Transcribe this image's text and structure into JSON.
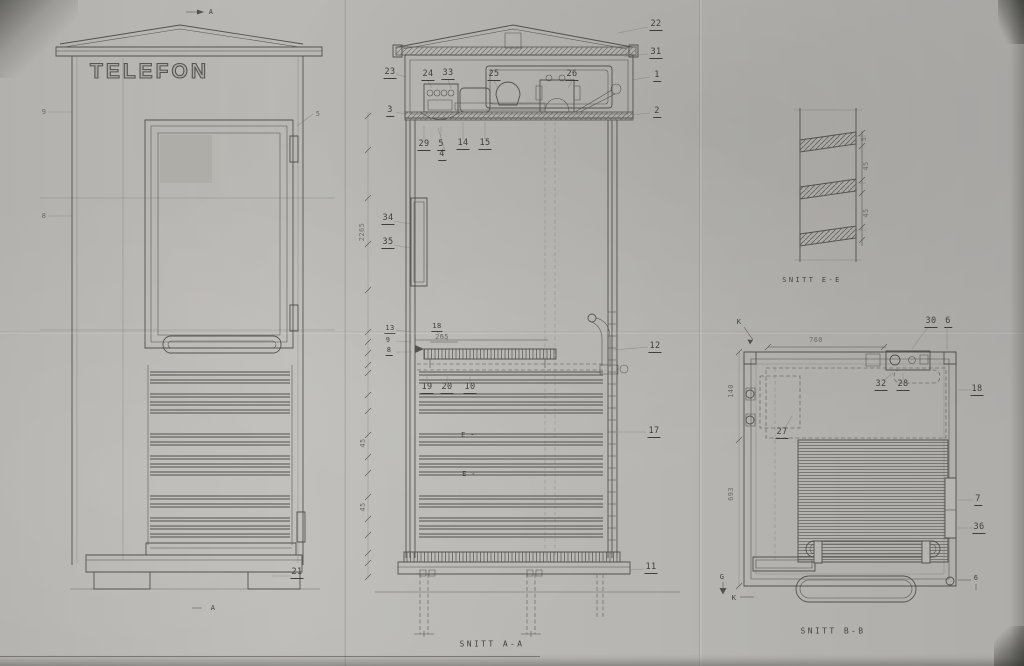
{
  "sheet": {
    "sign_text": "TELEFON"
  },
  "captions": {
    "section_aa": "SNITT A-A",
    "section_bb": "SNITT B-B",
    "section_ee": "SNITT E-E"
  },
  "colors": {
    "paper": "#b7b6b2",
    "line": "#46443f"
  },
  "part_labels": [
    {
      "t": "A",
      "x": 211,
      "y": 12,
      "sm": true,
      "name": "section-marker-a-top"
    },
    {
      "t": "9",
      "x": 44,
      "y": 112,
      "sm": true,
      "f": true
    },
    {
      "t": "8",
      "x": 44,
      "y": 216,
      "sm": true,
      "f": true
    },
    {
      "t": "5",
      "x": 318,
      "y": 114,
      "sm": true,
      "f": true
    },
    {
      "t": "21",
      "x": 297,
      "y": 573,
      "u": true
    },
    {
      "t": "A",
      "x": 213,
      "y": 608,
      "sm": true,
      "name": "section-marker-a-bottom"
    },
    {
      "t": "23",
      "x": 390,
      "y": 73,
      "u": true
    },
    {
      "t": "3",
      "x": 390,
      "y": 111,
      "u": true
    },
    {
      "t": "34",
      "x": 388,
      "y": 219,
      "u": true
    },
    {
      "t": "35",
      "x": 388,
      "y": 243,
      "u": true
    },
    {
      "t": "13",
      "x": 390,
      "y": 329,
      "u": true,
      "sm": true
    },
    {
      "t": "9",
      "x": 388,
      "y": 340,
      "sm": true
    },
    {
      "t": "8",
      "x": 389,
      "y": 351,
      "u": true,
      "sm": true
    },
    {
      "t": "24",
      "x": 428,
      "y": 75,
      "u": true
    },
    {
      "t": "33",
      "x": 448,
      "y": 74,
      "u": true
    },
    {
      "t": "25",
      "x": 494,
      "y": 75,
      "u": true
    },
    {
      "t": "26",
      "x": 572,
      "y": 75,
      "u": true
    },
    {
      "t": "29",
      "x": 424,
      "y": 145,
      "u": true
    },
    {
      "t": "5",
      "x": 441,
      "y": 145,
      "u": true
    },
    {
      "t": "14",
      "x": 463,
      "y": 144,
      "u": true
    },
    {
      "t": "15",
      "x": 485,
      "y": 144,
      "u": true
    },
    {
      "t": "4",
      "x": 442,
      "y": 155,
      "u": true
    },
    {
      "t": "18",
      "x": 437,
      "y": 327,
      "u": true,
      "sm": true
    },
    {
      "t": "265",
      "x": 442,
      "y": 337,
      "sm": true,
      "f": true,
      "name": "dimension-label"
    },
    {
      "t": "19",
      "x": 427,
      "y": 388,
      "u": true
    },
    {
      "t": "20",
      "x": 447,
      "y": 388,
      "u": true
    },
    {
      "t": "10",
      "x": 470,
      "y": 388,
      "u": true
    },
    {
      "t": "22",
      "x": 656,
      "y": 25,
      "u": true
    },
    {
      "t": "31",
      "x": 656,
      "y": 53,
      "u": true
    },
    {
      "t": "1",
      "x": 657,
      "y": 76,
      "u": true
    },
    {
      "t": "2",
      "x": 657,
      "y": 112,
      "u": true
    },
    {
      "t": "12",
      "x": 655,
      "y": 347,
      "u": true
    },
    {
      "t": "17",
      "x": 654,
      "y": 432,
      "u": true
    },
    {
      "t": "11",
      "x": 651,
      "y": 568,
      "u": true
    },
    {
      "t": "E -",
      "x": 468,
      "y": 435,
      "sm": true,
      "name": "section-marker-e1"
    },
    {
      "t": "E -",
      "x": 469,
      "y": 474,
      "sm": true,
      "name": "section-marker-e2"
    },
    {
      "t": "2265",
      "x": 362,
      "y": 232,
      "rot": true,
      "sm": true,
      "f": true,
      "name": "dimension-label"
    },
    {
      "t": "45",
      "x": 363,
      "y": 443,
      "rot": true,
      "sm": true,
      "f": true,
      "name": "dimension-label"
    },
    {
      "t": "45",
      "x": 363,
      "y": 507,
      "rot": true,
      "sm": true,
      "f": true,
      "name": "dimension-label"
    },
    {
      "t": "5",
      "x": 864,
      "y": 139,
      "rot": true,
      "sm": true,
      "f": true,
      "name": "dimension-label"
    },
    {
      "t": "45",
      "x": 866,
      "y": 166,
      "rot": true,
      "sm": true,
      "f": true,
      "name": "dimension-label"
    },
    {
      "t": "45",
      "x": 866,
      "y": 213,
      "rot": true,
      "sm": true,
      "f": true,
      "name": "dimension-label"
    },
    {
      "t": "K",
      "x": 739,
      "y": 322,
      "sm": true,
      "name": "section-marker-k-top"
    },
    {
      "t": "30",
      "x": 931,
      "y": 322,
      "u": true
    },
    {
      "t": "6",
      "x": 948,
      "y": 322,
      "u": true
    },
    {
      "t": "32",
      "x": 881,
      "y": 385,
      "u": true
    },
    {
      "t": "28",
      "x": 903,
      "y": 385,
      "u": true
    },
    {
      "t": "18",
      "x": 977,
      "y": 390,
      "u": true
    },
    {
      "t": "27",
      "x": 782,
      "y": 433,
      "u": true
    },
    {
      "t": "7",
      "x": 978,
      "y": 500,
      "u": true
    },
    {
      "t": "36",
      "x": 979,
      "y": 528,
      "u": true
    },
    {
      "t": "6",
      "x": 976,
      "y": 578,
      "sm": true
    },
    {
      "t": "G",
      "x": 722,
      "y": 577,
      "sm": true,
      "name": "section-marker-g"
    },
    {
      "t": "K",
      "x": 734,
      "y": 598,
      "sm": true,
      "name": "section-marker-k-bottom"
    },
    {
      "t": "760",
      "x": 816,
      "y": 340,
      "sm": true,
      "f": true,
      "name": "dimension-label"
    },
    {
      "t": "140",
      "x": 731,
      "y": 391,
      "rot": true,
      "sm": true,
      "f": true,
      "name": "dimension-label"
    },
    {
      "t": "693",
      "x": 731,
      "y": 494,
      "rot": true,
      "sm": true,
      "f": true,
      "name": "dimension-label"
    }
  ]
}
